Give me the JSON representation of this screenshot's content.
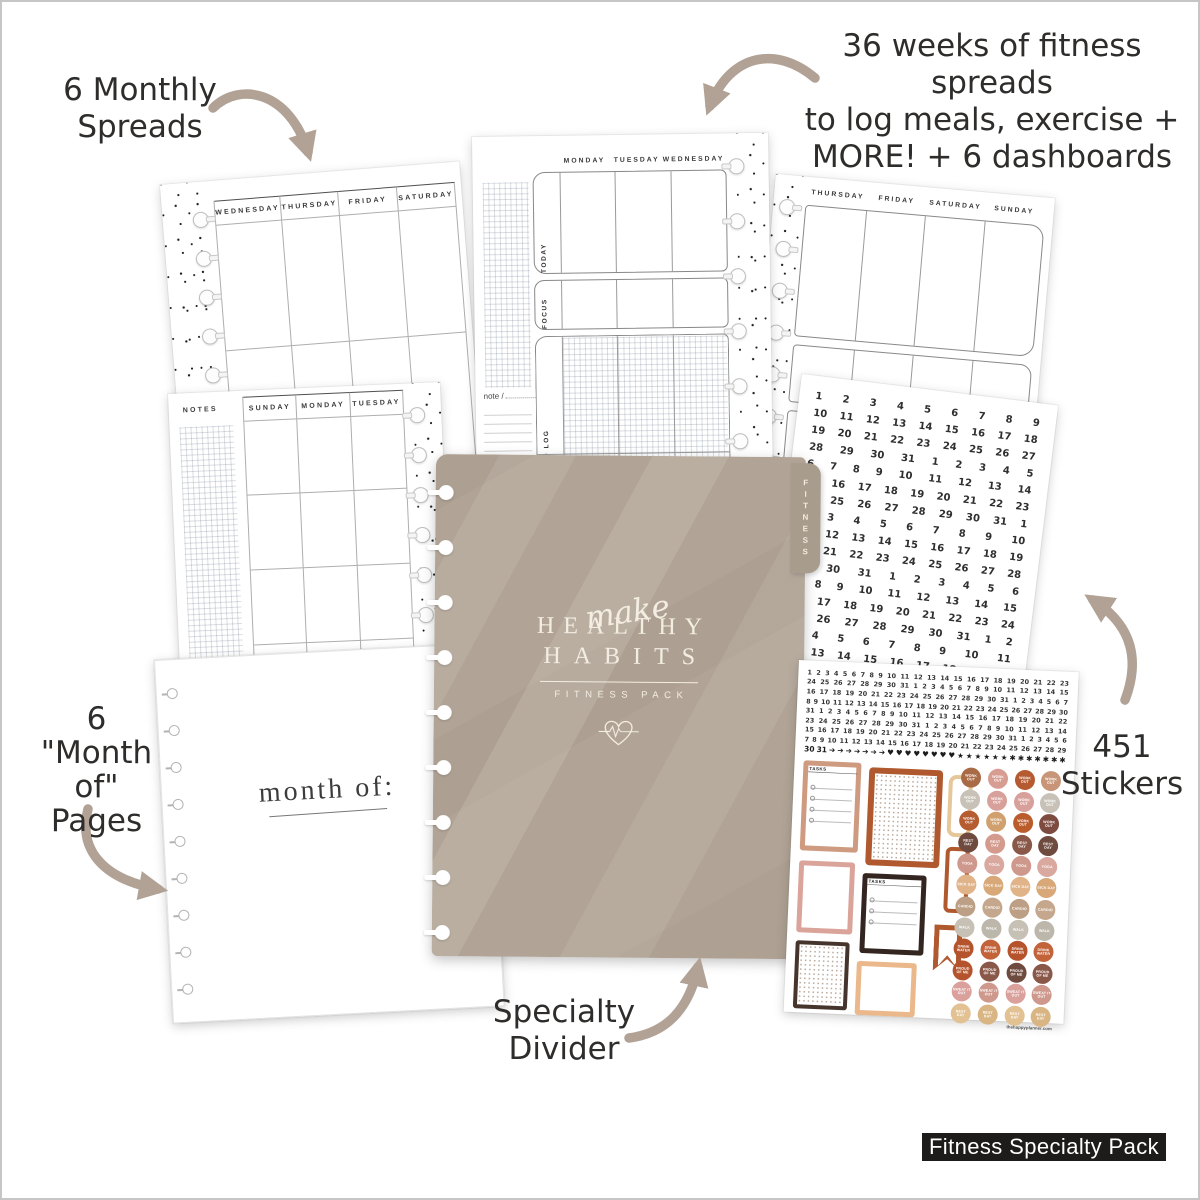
{
  "annotations": {
    "top_left": [
      "6 Monthly",
      "Spreads"
    ],
    "top_right": [
      "36 weeks of fitness spreads",
      "to log meals, exercise +",
      "MORE! + 6 dashboards"
    ],
    "left": [
      "6",
      "\"Month of\"",
      "Pages"
    ],
    "right": [
      "451",
      "Stickers"
    ],
    "bottom": [
      "Specialty",
      "Divider"
    ]
  },
  "badge": {
    "label": "Fitness Specialty Pack"
  },
  "divider": {
    "tab_label": "FITNESS",
    "script_word": "make",
    "title_line1": "HEALTHY",
    "title_line2": "HABITS",
    "subtitle": "FITNESS PACK",
    "color": "#b1a496",
    "heart_icon": "heart-ekg-icon",
    "arrow_color": "#b1a295"
  },
  "pages": {
    "monthly_right": {
      "days": [
        "WEDNESDAY",
        "THURSDAY",
        "FRIDAY",
        "SATURDAY"
      ]
    },
    "monthly_left": {
      "notes_label": "NOTES",
      "days": [
        "SUNDAY",
        "MONDAY",
        "TUESDAY"
      ]
    },
    "weekly_left": {
      "days": [
        "MONDAY",
        "TUESDAY",
        "WEDNESDAY"
      ],
      "sections": [
        "TODAY",
        "FOCUS",
        "FOOD LOG"
      ],
      "note_label": "note /"
    },
    "weekly_right": {
      "days": [
        "THURSDAY",
        "FRIDAY",
        "SATURDAY",
        "SUNDAY"
      ]
    },
    "month_of": {
      "label": "month of:"
    }
  },
  "stickers": {
    "date_sheet_rows": [
      "1 2 3 4 5 6 7 8 9",
      "10 11 12 13 14 15 16 17 18",
      "19 20 21 22 23 24 25 26 27",
      "28 29 30 31 1 2 3 4 5",
      "6 7 8 9 10 11 12 13 14",
      "15 16 17 18 19 20 21 22 23",
      "24 25 26 27 28 29 30 31 1",
      "2 3 4 5 6 7 8 9 10",
      "11 12 13 14 15 16 17 18 19",
      "20 21 22 23 24 25 26 27 28",
      "29 30 31 1 2 3 4 5 6",
      "7 8 9 10 11 12 13 14 15",
      "16 17 18 19 20 21 22 23 24",
      "25 26 27 28 29 30 31 1 2",
      "3 4 5 6 7 8 9 10 11",
      "12 13 14 15 16 17 18 19 20"
    ],
    "small_date_rows": [
      "1 2 3 4 5 6 7 8 9 10 11 12 13 14 15 16 17 18 19 20 21 22 23",
      "24 25 26 27 28 29 30 31 1 2 3 4 5 6 7 8 9 10 11 12 13 14 15",
      "16 17 18 19 20 21 22 23 24 25 26 27 28 29 30 31 1 2 3 4 5 6 7",
      "8 9 10 11 12 13 14 15 16 17 18 19 20 21 22 23 24 25 26 27 28 29 30",
      "31 1 2 3 4 5 6 7 8 9 10 11 12 13 14 15 16 17 18 19 20 21 22",
      "23 24 25 26 27 28 29 30 31 1 2 3 4 5 6 7 8 9 10 11 12 13 14",
      "15 16 17 18 19 20 21 22 23 24 25 26 27 28 29 30 31 1 2 3 4 5 6",
      "7 8 9 10 11 12 13 14 15 16 17 18 19 20 21 22 23 24 25 26 27 28 29"
    ],
    "symbol_row": "30 31 ➔ ➔ ➔ ➔ ➔ ➔ ➔ ♥ ♥ ♥ ♥ ♥ ♥ ♥ ♥ ★ ★ ★ ★ ★ ★ ✱ ✱ ✱ ✱ ✱ ✱ ✱",
    "tasks_label": "TASKS",
    "circle_rows": [
      {
        "label": "WORK OUT",
        "colors": [
          "#a96a46",
          "#d79d92",
          "#b65b31",
          "#c89579"
        ]
      },
      {
        "label": "WORK OUT",
        "colors": [
          "#c8c1b7",
          "#d8a09b",
          "#d8a09b",
          "#c8c1b7"
        ]
      },
      {
        "label": "WORK OUT",
        "colors": [
          "#b55c31",
          "#d0a06e",
          "#bb5c2d",
          "#7d4b40"
        ]
      },
      {
        "label": "REST DAY",
        "colors": [
          "#6f4a3e",
          "#d49a8e",
          "#8a5848",
          "#6f4a3e"
        ]
      },
      {
        "label": "YOGA",
        "colors": [
          "#cf988c",
          "#d9a9a0",
          "#cf988c",
          "#d9a9a0"
        ]
      },
      {
        "label": "SICK DAY",
        "colors": [
          "#e0b488",
          "#d8a878",
          "#e0b488",
          "#d8a878"
        ]
      },
      {
        "label": "CARDIO",
        "colors": [
          "#bd9f85",
          "#c4a78c",
          "#bd9f85",
          "#c4a78c"
        ]
      },
      {
        "label": "WALK",
        "colors": [
          "#c6c0b5",
          "#bdb7ab",
          "#c6c0b5",
          "#bdb7ab"
        ]
      },
      {
        "label": "DRINK WATER",
        "colors": [
          "#b5542c",
          "#c2633a",
          "#b5542c",
          "#c2633a"
        ]
      },
      {
        "label": "PROUD OF ME",
        "colors": [
          "#b5542c",
          "#8a5848",
          "#6f4a3e",
          "#8a5848"
        ]
      },
      {
        "label": "SWEAT IT OUT",
        "colors": [
          "#d9a09c",
          "#cf988c",
          "#d9a09c",
          "#cf988c"
        ]
      },
      {
        "label": "REST DAY",
        "colors": [
          "#e2c193",
          "#d8b583",
          "#e2c193",
          "#d8b583"
        ]
      }
    ],
    "site_label": "thehappyplanner.com"
  }
}
